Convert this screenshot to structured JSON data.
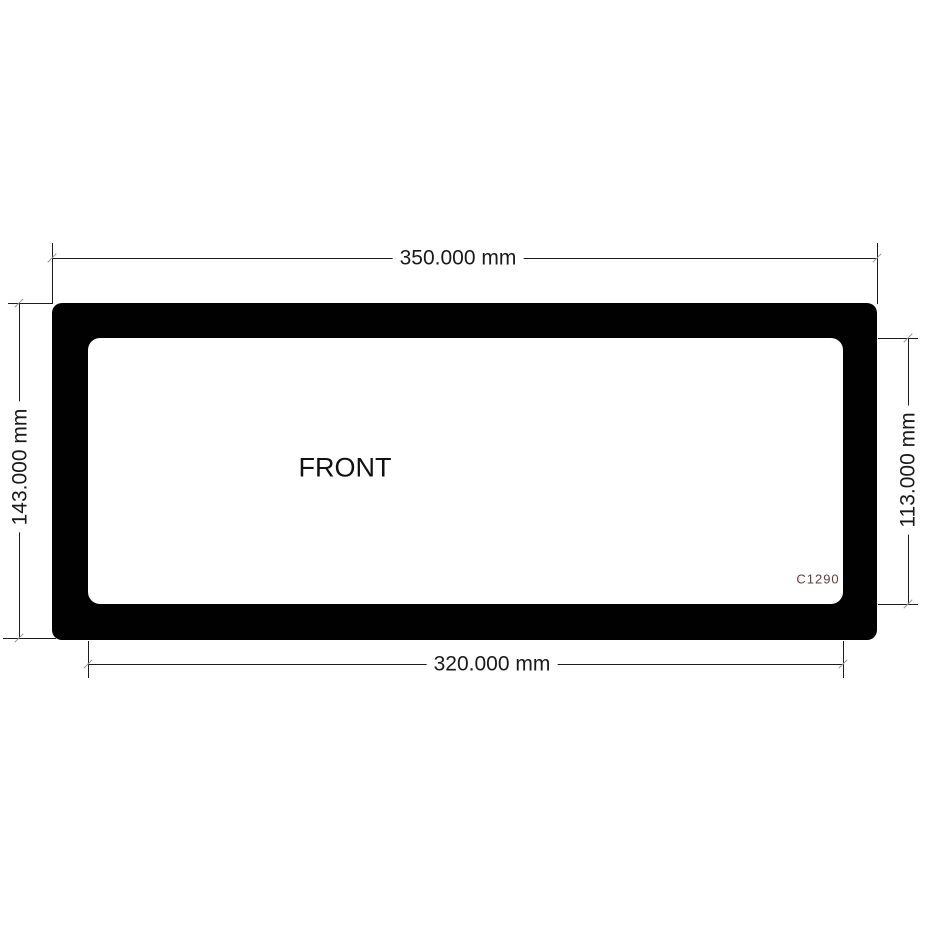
{
  "drawing": {
    "part_label": "FRONT",
    "part_code": "C1290",
    "dimensions": {
      "outer_width": {
        "label": "350.000 mm",
        "value_mm": 350.0,
        "side": "top",
        "measures": "outer width of frame"
      },
      "outer_height": {
        "label": "143.000 mm",
        "value_mm": 143.0,
        "side": "left",
        "measures": "outer height of frame"
      },
      "inner_width": {
        "label": "320.000 mm",
        "value_mm": 320.0,
        "side": "bottom",
        "measures": "inner opening width"
      },
      "inner_height": {
        "label": "113.000 mm",
        "value_mm": 113.0,
        "side": "right",
        "measures": "inner opening height"
      }
    },
    "colors": {
      "background": "#ffffff",
      "frame_fill": "#010101",
      "dimension_line": "#1c1c1c",
      "dimension_text": "#1a1a1a",
      "part_code_text": "#6e3a3a"
    }
  }
}
